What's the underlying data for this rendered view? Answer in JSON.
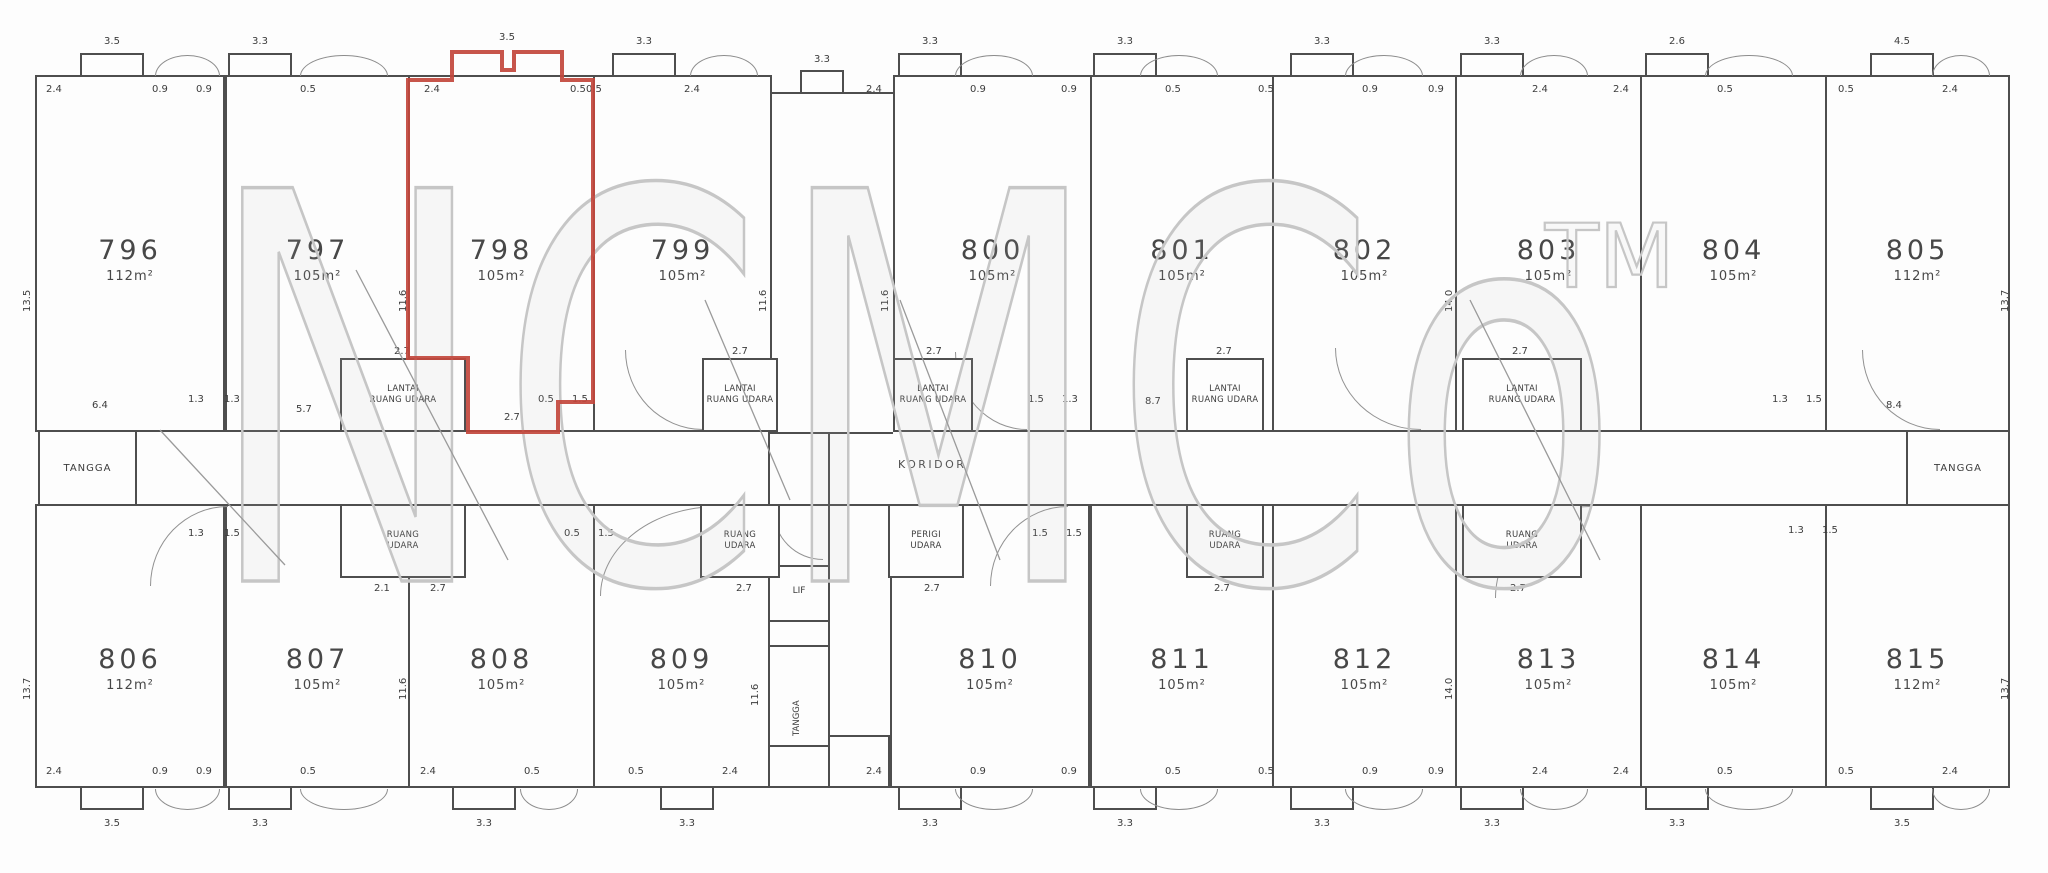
{
  "plan": {
    "watermark": {
      "text": "NCMCo",
      "tm": "TM"
    },
    "labels": {
      "corridor": "KORIDOR",
      "stairs_left": "TANGGA",
      "stairs_right": "TANGGA",
      "lift": "LIF",
      "core_stairs": "TANGGA"
    },
    "colors": {
      "wall": "#4e4e4e",
      "highlight": "#c2463c",
      "watermark": "#c6c6c6",
      "dim_text": "#3c3c3c"
    },
    "units_top": [
      {
        "no": "796",
        "area": "112m²",
        "top_dim": "3.5",
        "left_dim": "2.4",
        "right_dim": "0.9",
        "side_dim": "13.5",
        "highlighted": false
      },
      {
        "no": "797",
        "area": "105m²",
        "top_dim": "3.3",
        "left_dim": "0.9",
        "right_dim": "0.5",
        "side_dim": "11.6",
        "highlighted": false
      },
      {
        "no": "798",
        "area": "105m²",
        "top_dim": "3.5",
        "left_dim": "2.4",
        "right_dim": "0.5",
        "side_dim": "11.6",
        "highlighted": true
      },
      {
        "no": "799",
        "area": "105m²",
        "top_dim": "3.3",
        "left_dim": "0.5",
        "right_dim": "2.4",
        "side_dim": "11.6",
        "highlighted": false
      },
      {
        "no": "800",
        "area": "105m²",
        "top_dim": "3.3",
        "left_dim": "2.4",
        "right_dim": "0.9",
        "side_dim": "11.6",
        "highlighted": false
      },
      {
        "no": "801",
        "area": "105m²",
        "top_dim": "3.3",
        "left_dim": "0.9",
        "right_dim": "0.5",
        "side_dim": "11.6",
        "highlighted": false
      },
      {
        "no": "802",
        "area": "105m²",
        "top_dim": "3.3",
        "left_dim": "0.5",
        "right_dim": "0.9",
        "side_dim": "14.0",
        "highlighted": false
      },
      {
        "no": "803",
        "area": "105m²",
        "top_dim": "3.3",
        "left_dim": "0.9",
        "right_dim": "2.4",
        "side_dim": "11.6",
        "highlighted": false
      },
      {
        "no": "804",
        "area": "105m²",
        "top_dim": "2.6",
        "left_dim": "2.4",
        "right_dim": "0.5",
        "side_dim": "11.6",
        "highlighted": false
      },
      {
        "no": "805",
        "area": "112m²",
        "top_dim": "4.5",
        "left_dim": "0.5",
        "right_dim": "2.4",
        "side_dim": "13.7",
        "highlighted": false
      }
    ],
    "units_bottom": [
      {
        "no": "806",
        "area": "112m²",
        "bottom_dim": "3.5",
        "left_dim": "2.4",
        "right_dim": "0.9",
        "side_dim": "13.7",
        "highlighted": false
      },
      {
        "no": "807",
        "area": "105m²",
        "bottom_dim": "3.3",
        "left_dim": "0.9",
        "right_dim": "0.5",
        "side_dim": "11.6",
        "highlighted": false
      },
      {
        "no": "808",
        "area": "105m²",
        "bottom_dim": "3.3",
        "left_dim": "2.4",
        "right_dim": "0.5",
        "side_dim": "11.6",
        "highlighted": false
      },
      {
        "no": "809",
        "area": "105m²",
        "bottom_dim": "3.3",
        "left_dim": "0.5",
        "right_dim": "2.4",
        "side_dim": "11.6",
        "highlighted": false
      },
      {
        "no": "810",
        "area": "105m²",
        "bottom_dim": "3.3",
        "left_dim": "2.4",
        "right_dim": "0.9",
        "side_dim": "11.6",
        "highlighted": false
      },
      {
        "no": "811",
        "area": "105m²",
        "bottom_dim": "3.3",
        "left_dim": "0.9",
        "right_dim": "0.5",
        "side_dim": "11.6",
        "highlighted": false
      },
      {
        "no": "812",
        "area": "105m²",
        "bottom_dim": "3.3",
        "left_dim": "0.5",
        "right_dim": "0.9",
        "side_dim": "14.0",
        "highlighted": false
      },
      {
        "no": "813",
        "area": "105m²",
        "bottom_dim": "3.3",
        "left_dim": "0.9",
        "right_dim": "2.4",
        "side_dim": "11.6",
        "highlighted": false
      },
      {
        "no": "814",
        "area": "105m²",
        "bottom_dim": "3.3",
        "left_dim": "2.4",
        "right_dim": "0.5",
        "side_dim": "11.6",
        "highlighted": false
      },
      {
        "no": "815",
        "area": "112m²",
        "bottom_dim": "3.5",
        "left_dim": "0.5",
        "right_dim": "2.4",
        "side_dim": "13.7",
        "highlighted": false
      }
    ],
    "utility_boxes_top": [
      {
        "line1": "LANTAI",
        "line2": "RUANG UDARA"
      },
      {
        "line1": "LANTAI",
        "line2": "RUANG UDARA"
      },
      {
        "line1": "LANTAI",
        "line2": "RUANG UDARA"
      },
      {
        "line1": "LANTAI",
        "line2": "RUANG UDARA"
      },
      {
        "line1": "LANTAI",
        "line2": "RUANG UDARA"
      }
    ],
    "utility_boxes_bottom": [
      {
        "line1": "RUANG",
        "line2": "UDARA"
      },
      {
        "line1": "RUANG",
        "line2": "UDARA"
      },
      {
        "line1": "PERIGI",
        "line2": "UDARA"
      },
      {
        "line1": "RUANG",
        "line2": "UDARA"
      },
      {
        "line1": "RUANG",
        "line2": "UDARA"
      }
    ],
    "dims": {
      "box_width": "2.7",
      "box_depth": "2.1",
      "junction_a": "1.3",
      "junction_b": "1.5",
      "junction_c": "0.5",
      "corridor_left": "6.4",
      "corridor_right": "8.4",
      "mid_a": "5.7",
      "mid_b": "8.7",
      "gap_bump": "3.3"
    }
  }
}
